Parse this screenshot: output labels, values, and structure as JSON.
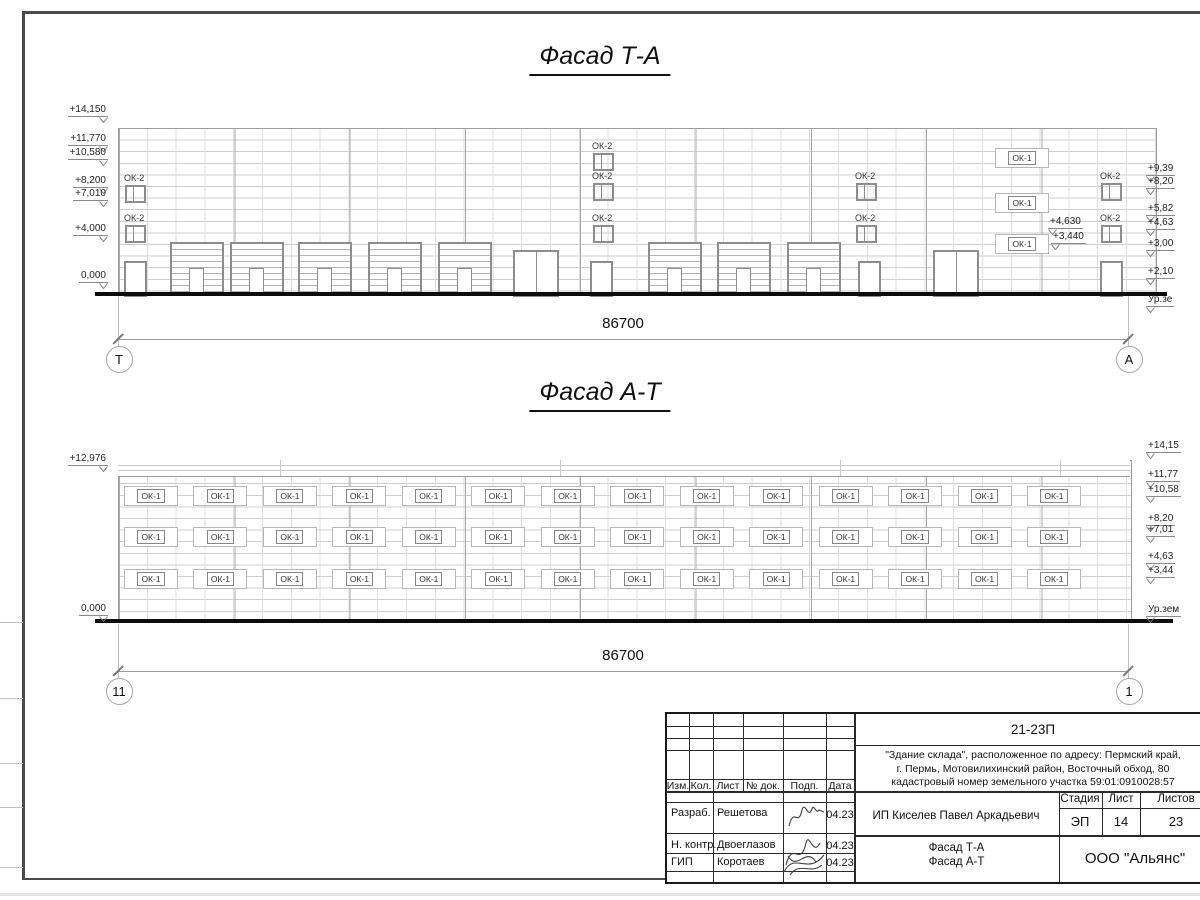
{
  "facades": [
    {
      "title": "Фасад Т-А",
      "dimension": "86700",
      "axis_left": "Т",
      "axis_right": "А",
      "elev_left": [
        "+14,150",
        "+11,770",
        "+10,580",
        "+8,200",
        "+7,010",
        "+4,000",
        "0,000"
      ],
      "elev_right": [
        "+9,39",
        "+8,20",
        "+5,82",
        "+4,63",
        "+3,00",
        "+2,10",
        "Ур.зе"
      ],
      "elev_mid": [
        "+4,630",
        "+3,440"
      ],
      "ok2_label": "ОК-2",
      "ok1_label": "ОК-1"
    },
    {
      "title": "Фасад А-Т",
      "dimension": "86700",
      "axis_left": "11",
      "axis_right": "1",
      "elev_left": [
        "+12,976",
        "0,000"
      ],
      "elev_right": [
        "+14,15",
        "+11,77",
        "+10,58",
        "+8,20",
        "+7,01",
        "+4,63",
        "+3,44",
        "Ур.зем"
      ],
      "ok1_label": "ОК-1",
      "window_columns": 14,
      "window_rows": 3
    }
  ],
  "titleblock": {
    "doc_number": "21-23П",
    "project_desc": "\"Здание склада\", расположенное по адресу: Пермский край,\nг. Пермь, Мотовилихинский район, Восточный обход, 80\nкадастровый номер земельного участка 59:01:0910028:57",
    "rev_headers": [
      "Изм.",
      "Кол.",
      "Лист",
      "№ док.",
      "Подп.",
      "Дата"
    ],
    "signoff": [
      {
        "role": "Разраб.",
        "name": "Решетова",
        "date": "04.23"
      },
      {
        "role": "Н. контр.",
        "name": "Двоеглазов",
        "date": "04.23"
      },
      {
        "role": "ГИП",
        "name": "Коротаев",
        "date": "04.23"
      }
    ],
    "client": "ИП Киселев Павел Аркадьевич",
    "stage_label": "Стадия",
    "sheet_label": "Лист",
    "total_label": "Листов",
    "stage": "ЭП",
    "sheet": "14",
    "total": "23",
    "drawing_title": "Фасад Т-А\nФасад А-Т",
    "organization": "ООО \"Альянс\""
  }
}
